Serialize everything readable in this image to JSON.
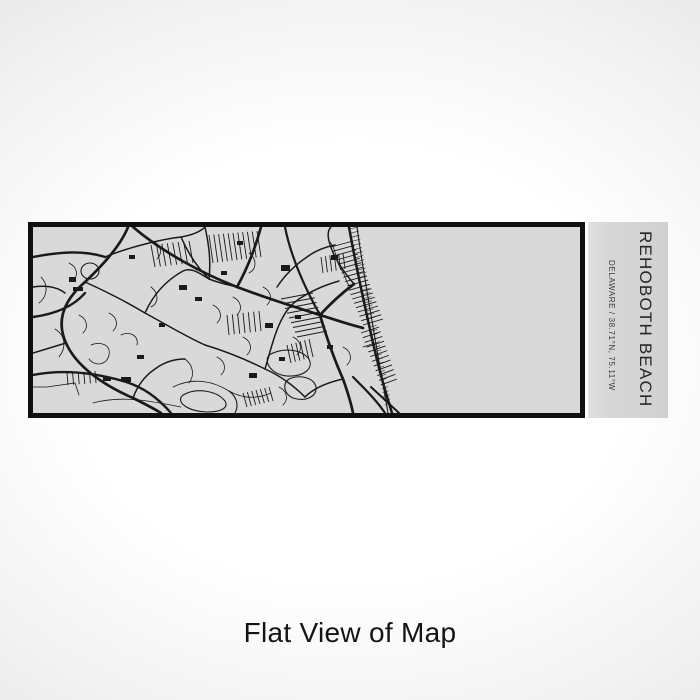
{
  "product": {
    "title": "REHOBOTH BEACH",
    "subtitle": "DELAWARE / 38.71°N, 75.11°W"
  },
  "caption": "Flat View of Map",
  "colors": {
    "bg_center": "#ffffff",
    "bg_edge": "#e2e2e2",
    "map_bg": "#d9d9d9",
    "panel_bg": "#d6d6d6",
    "frame": "#101010",
    "ink": "#1a1a1a",
    "caption": "#141414"
  },
  "map": {
    "roads": [
      {
        "d": "M100,0 C128,24 168,46 204,60 C236,72 262,80 287,88",
        "w": 2.7
      },
      {
        "d": "M228,0 C222,22 214,42 204,60",
        "w": 2.7
      },
      {
        "d": "M287,88 C300,92 314,97 330,101",
        "w": 2.7
      },
      {
        "d": "M287,88 C297,77 309,66 321,57",
        "w": 2.7
      },
      {
        "d": "M287,88 C294,112 302,134 310,152 C315,166 318,176 320,186",
        "w": 2.7
      },
      {
        "d": "M316,0 C321,28 328,62 336,98 C342,126 350,158 359,186",
        "w": 2.5
      },
      {
        "d": "M95,0 C88,18 70,38 52,55 C30,74 23,94 33,116 C43,139 70,158 100,171 C112,177 120,181 128,186",
        "w": 2.7
      },
      {
        "d": "M0,90 C22,87 40,80 52,66",
        "w": 2.4
      },
      {
        "d": "M0,148 C30,142 62,146 90,154 C110,160 124,170 138,186",
        "w": 2.4
      },
      {
        "d": "M252,0 C257,26 270,58 287,88",
        "w": 2.2
      },
      {
        "d": "M320,150 C332,162 344,174 352,186",
        "w": 2.2
      },
      {
        "d": "M338,160 L366,186",
        "w": 2.0
      },
      {
        "d": "M0,30 C26,25 50,23 72,30",
        "w": 2.4
      },
      {
        "d": "M324,0 C332,58 344,122 355,186",
        "w": 1.1
      },
      {
        "d": "M72,30 C96,20 130,12 148,10 C160,8 168,4 172,0",
        "w": 1.5
      },
      {
        "d": "M52,55 C72,64 92,74 112,86 C134,98 154,110 172,118",
        "w": 1.5
      },
      {
        "d": "M172,118 C192,124 212,132 232,142 C250,150 262,160 272,170",
        "w": 1.5
      },
      {
        "d": "M33,116 L0,126",
        "w": 1.5
      },
      {
        "d": "M112,86 C120,68 132,54 150,44 C158,40 166,46 176,52",
        "w": 1.5
      },
      {
        "d": "M176,52 C186,56 196,58 204,60",
        "w": 1.5
      },
      {
        "d": "M172,0 C176,18 178,34 176,52",
        "w": 1.5
      },
      {
        "d": "M232,142 C238,122 242,104 250,90 C254,82 260,76 266,72",
        "w": 1.5
      },
      {
        "d": "M272,170 C280,162 292,156 310,152",
        "w": 1.5
      },
      {
        "d": "M100,171 C104,160 110,150 122,142 C130,136 140,132 152,132",
        "w": 1.5
      },
      {
        "d": "M148,10 C154,24 162,38 176,52",
        "w": 1.5
      },
      {
        "d": "M244,60 C252,48 262,38 274,30 C282,24 292,20 302,18",
        "w": 1.5
      },
      {
        "d": "M266,72 C278,64 292,58 306,54",
        "w": 1.5
      },
      {
        "d": "M0,60 C14,58 24,60 32,66",
        "w": 1.5
      },
      {
        "d": "M321,57 C310,44 300,30 296,14 C294,6 296,2 298,0",
        "w": 1.5
      },
      {
        "d": "M8,50 C16,58 14,70 6,76",
        "w": 0.8
      },
      {
        "d": "M22,102 C32,108 34,120 26,130",
        "w": 0.8
      },
      {
        "d": "M58,118 C68,114 78,118 76,128 C74,138 62,140 56,132",
        "w": 0.8
      },
      {
        "d": "M14,160 L42,156 L46,168",
        "w": 0.8
      },
      {
        "d": "M88,108 C96,104 106,108 104,118",
        "w": 0.8
      },
      {
        "d": "M118,60 C126,66 126,76 118,80",
        "w": 0.8
      },
      {
        "d": "M140,160 C160,150 180,154 196,164 C210,172 224,172 238,166",
        "w": 0.8
      },
      {
        "d": "M60,176 C88,168 118,174 148,180",
        "w": 0.8
      },
      {
        "d": "M200,70 C208,74 210,82 204,88",
        "w": 0.8
      },
      {
        "d": "M216,26 C224,32 224,42 216,46",
        "w": 0.8
      },
      {
        "d": "M260,110 C268,114 270,122 264,128",
        "w": 0.8
      },
      {
        "d": "M184,130 C192,134 194,142 188,148",
        "w": 0.8
      },
      {
        "d": "M152,132 C160,138 162,148 156,156",
        "w": 0.8
      },
      {
        "d": "M296,14 C304,22 302,34 308,42 C314,50 312,56 318,60",
        "w": 0.8
      },
      {
        "d": "M246,160 C254,164 256,172 250,178",
        "w": 0.8
      },
      {
        "d": "M120,14 C128,18 130,26 124,32",
        "w": 0.8
      },
      {
        "d": "M76,86 C84,90 86,98 80,104",
        "w": 0.8
      },
      {
        "d": "M36,36 C44,40 46,48 40,54",
        "w": 0.8
      },
      {
        "d": "M180,78 C188,82 190,90 184,96",
        "w": 0.8
      },
      {
        "d": "M210,110 C218,114 220,122 214,128",
        "w": 0.8
      },
      {
        "d": "M230,60 C238,64 240,72 234,78",
        "w": 0.8
      },
      {
        "d": "M310,120 C318,124 320,132 314,138",
        "w": 0.8
      },
      {
        "d": "M330,120 L342,116",
        "w": 0.8
      },
      {
        "d": "M0,160 L14,160",
        "w": 0.8
      },
      {
        "d": "M46,88 C54,92 56,100 50,106",
        "w": 0.8
      }
    ],
    "water": [
      {
        "d": "M236,128 C250,120 268,122 276,132 C281,142 270,150 254,149 C240,148 230,136 236,128 Z"
      },
      {
        "d": "M256,152 C268,147 281,151 283,160 C284,170 272,175 260,171 C251,167 249,157 256,152 Z"
      },
      {
        "d": "M48,44 a9,8 0 1,0 18,0 a9,8 0 1,0 -18,0"
      },
      {
        "d": "M150,168 C164,160 184,164 192,174 C196,181 188,185 174,185 C158,185 141,176 150,168 Z"
      },
      {
        "d": "M196,164 C204,170 206,178 202,186"
      }
    ],
    "hatch_bands": [
      {
        "a": [
          298,
          20,
          330,
          98
        ],
        "b": [
          320,
          14,
          350,
          92
        ],
        "n": 19,
        "w": 0.9
      },
      {
        "a": [
          328,
          106,
          348,
          158
        ],
        "b": [
          346,
          100,
          364,
          152
        ],
        "n": 12,
        "w": 0.9
      },
      {
        "a": [
          248,
          72,
          264,
          110
        ],
        "b": [
          280,
          66,
          294,
          104
        ],
        "n": 9,
        "w": 0.9
      },
      {
        "a": [
          176,
          8,
          224,
          4
        ],
        "b": [
          180,
          36,
          228,
          30
        ],
        "n": 11,
        "w": 0.9
      },
      {
        "a": [
          118,
          18,
          156,
          14
        ],
        "b": [
          122,
          40,
          160,
          36
        ],
        "n": 8,
        "w": 0.9
      },
      {
        "a": [
          194,
          88,
          226,
          84
        ],
        "b": [
          196,
          108,
          228,
          104
        ],
        "n": 7,
        "w": 0.9
      },
      {
        "a": [
          34,
          146,
          62,
          144
        ],
        "b": [
          35,
          158,
          63,
          156
        ],
        "n": 6,
        "w": 0.9
      },
      {
        "a": [
          254,
          118,
          276,
          112
        ],
        "b": [
          258,
          136,
          280,
          130
        ],
        "n": 6,
        "w": 0.9
      },
      {
        "a": [
          210,
          166,
          236,
          160
        ],
        "b": [
          214,
          180,
          240,
          174
        ],
        "n": 7,
        "w": 0.9
      },
      {
        "a": [
          288,
          30,
          310,
          26
        ],
        "b": [
          290,
          46,
          312,
          42
        ],
        "n": 6,
        "w": 0.9
      },
      {
        "a": [
          317,
          2,
          352,
          178
        ],
        "b": [
          325,
          0,
          358,
          176
        ],
        "n": 44,
        "w": 0.55
      }
    ],
    "buildings": [
      [
        146,
        58,
        8,
        5
      ],
      [
        96,
        28,
        6,
        4
      ],
      [
        248,
        38,
        9,
        6
      ],
      [
        298,
        28,
        7,
        5
      ],
      [
        204,
        14,
        6,
        4
      ],
      [
        232,
        96,
        8,
        5
      ],
      [
        262,
        88,
        6,
        4
      ],
      [
        36,
        50,
        7,
        5
      ],
      [
        40,
        60,
        10,
        4
      ],
      [
        88,
        150,
        10,
        5
      ],
      [
        70,
        150,
        8,
        4
      ],
      [
        246,
        130,
        6,
        4
      ],
      [
        188,
        44,
        6,
        4
      ],
      [
        162,
        70,
        7,
        4
      ],
      [
        216,
        146,
        8,
        5
      ],
      [
        294,
        118,
        6,
        4
      ],
      [
        126,
        96,
        6,
        4
      ],
      [
        104,
        128,
        7,
        4
      ]
    ]
  }
}
